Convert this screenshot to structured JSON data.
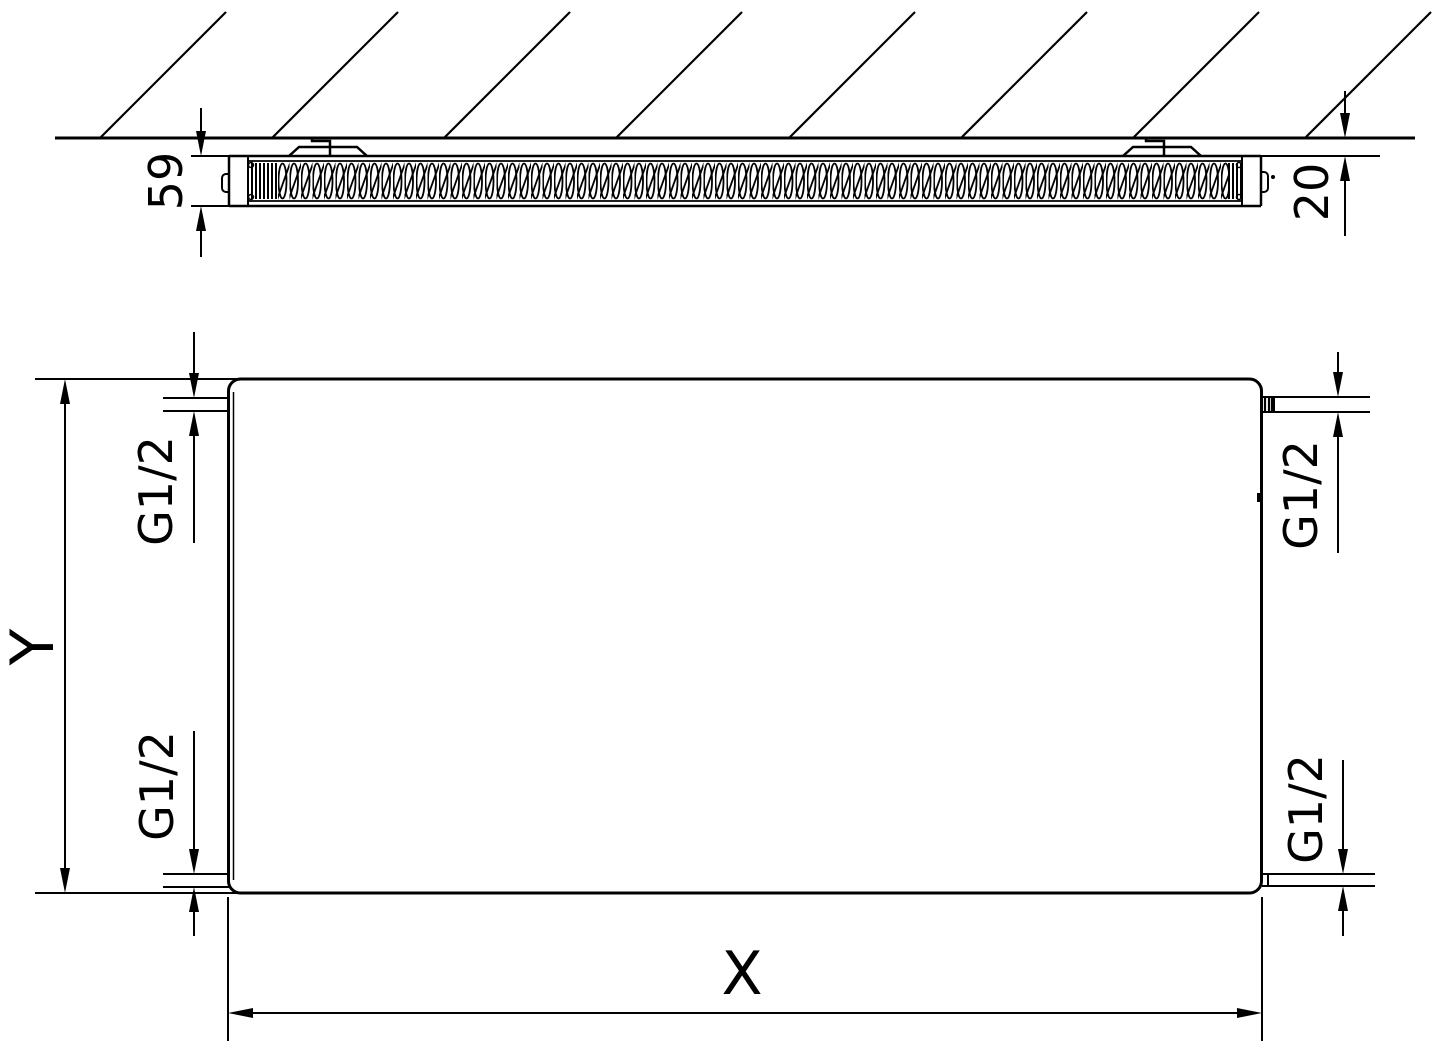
{
  "section_view": {
    "depth_dim_label": "59",
    "wall_clearance_dim_label": "20"
  },
  "front_view": {
    "height_dim_label": "Y",
    "width_dim_label": "X",
    "connection_top_left_label": "G1/2",
    "connection_bottom_left_label": "G1/2",
    "connection_top_right_label": "G1/2",
    "connection_bottom_right_label": "G1/2"
  },
  "colors": {
    "line": "#000000",
    "background": "#ffffff"
  }
}
